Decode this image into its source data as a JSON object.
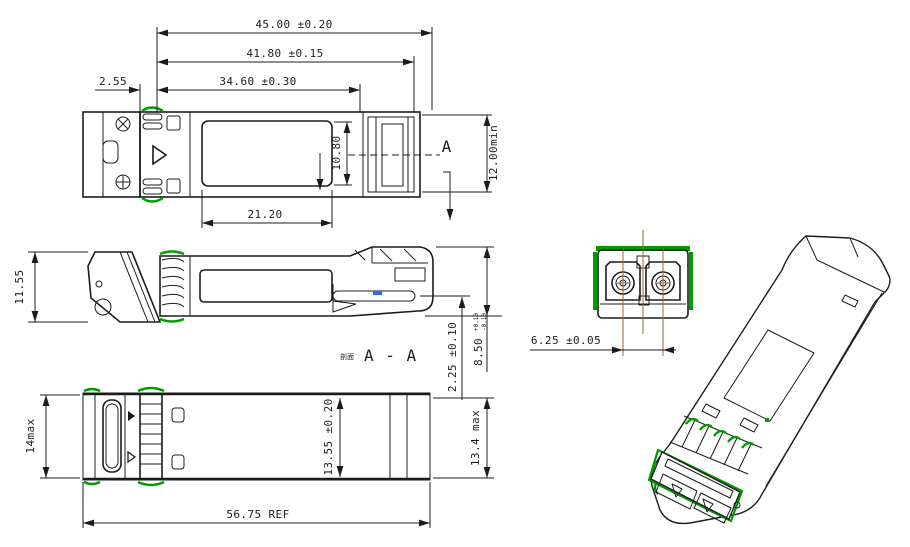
{
  "drawing": {
    "title": "SFP optical transceiver mechanical outline drawing",
    "colors": {
      "line": "#1c1c1c",
      "gasket_green": "#009b00",
      "centerline_brown": "#996633",
      "pcb_highlight_blue": "#3366ff",
      "background": "#ffffff"
    },
    "top_view": {
      "dim_overall_length": "45.00 ±0.20",
      "dim_latch_length": "41.80 ±0.15",
      "dim_body_length": "34.60 ±0.30",
      "dim_gasket_offset": "2.55",
      "dim_label_length": "21.20",
      "dim_label_width": "10.80",
      "dim_connector_depth": "12.00min",
      "section_arrow_label": "A"
    },
    "side_view": {
      "dim_height": "11.55",
      "dim_pcb_to_bottom": "2.25 ±0.10",
      "dim_nose_height": "8.50",
      "dim_nose_tol_upper": "+0.10",
      "dim_nose_tol_lower": "-0.10",
      "section_prefix": "剖面",
      "section_title": "A - A"
    },
    "bottom_view": {
      "dim_front_width": "14max",
      "dim_body_width": "13.55 ±0.20",
      "dim_rear_width": "13.4 max",
      "dim_overall_ref": "56.75 REF"
    },
    "front_view": {
      "dim_lc_pitch": "6.25 ±0.05"
    }
  }
}
